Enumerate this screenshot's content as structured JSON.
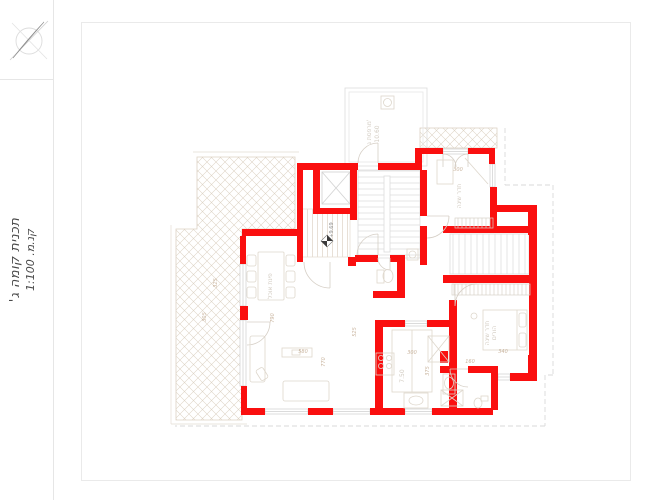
{
  "page": {
    "background": "#ffffff",
    "frame_color": "#eaeaea"
  },
  "sidebar": {
    "compass_icon": "north-arrow",
    "title_line1": "תכנית קומה ג'",
    "title_line2": "קנ.מ. 1:100"
  },
  "colors": {
    "wall_red": "#fa0f0f",
    "linework_gray": "#dcdcdc",
    "hatch_tan": "#ddd2c4",
    "furniture_tan": "#ded7cc",
    "dimension_text": "#c9b49e",
    "label_text": "#d2cbc1"
  },
  "plan": {
    "level_marker": "+9.69",
    "dimensions": {
      "d300a": "300",
      "d300b": "300",
      "d375": "375",
      "d340": "340",
      "d160": "160",
      "d790": "790",
      "d525": "525",
      "d580": "580",
      "d770": "770",
      "d305": "305",
      "d325": "325"
    },
    "labels": {
      "roof_room": "מרפסת ג'",
      "roof_area": "10.60",
      "bedroom1": "חדר שינה",
      "bedroom2": "חדר שינה",
      "bedroom2b": "הורים",
      "kitchen_area": "7.50",
      "dining": "פינת אוכל"
    }
  }
}
